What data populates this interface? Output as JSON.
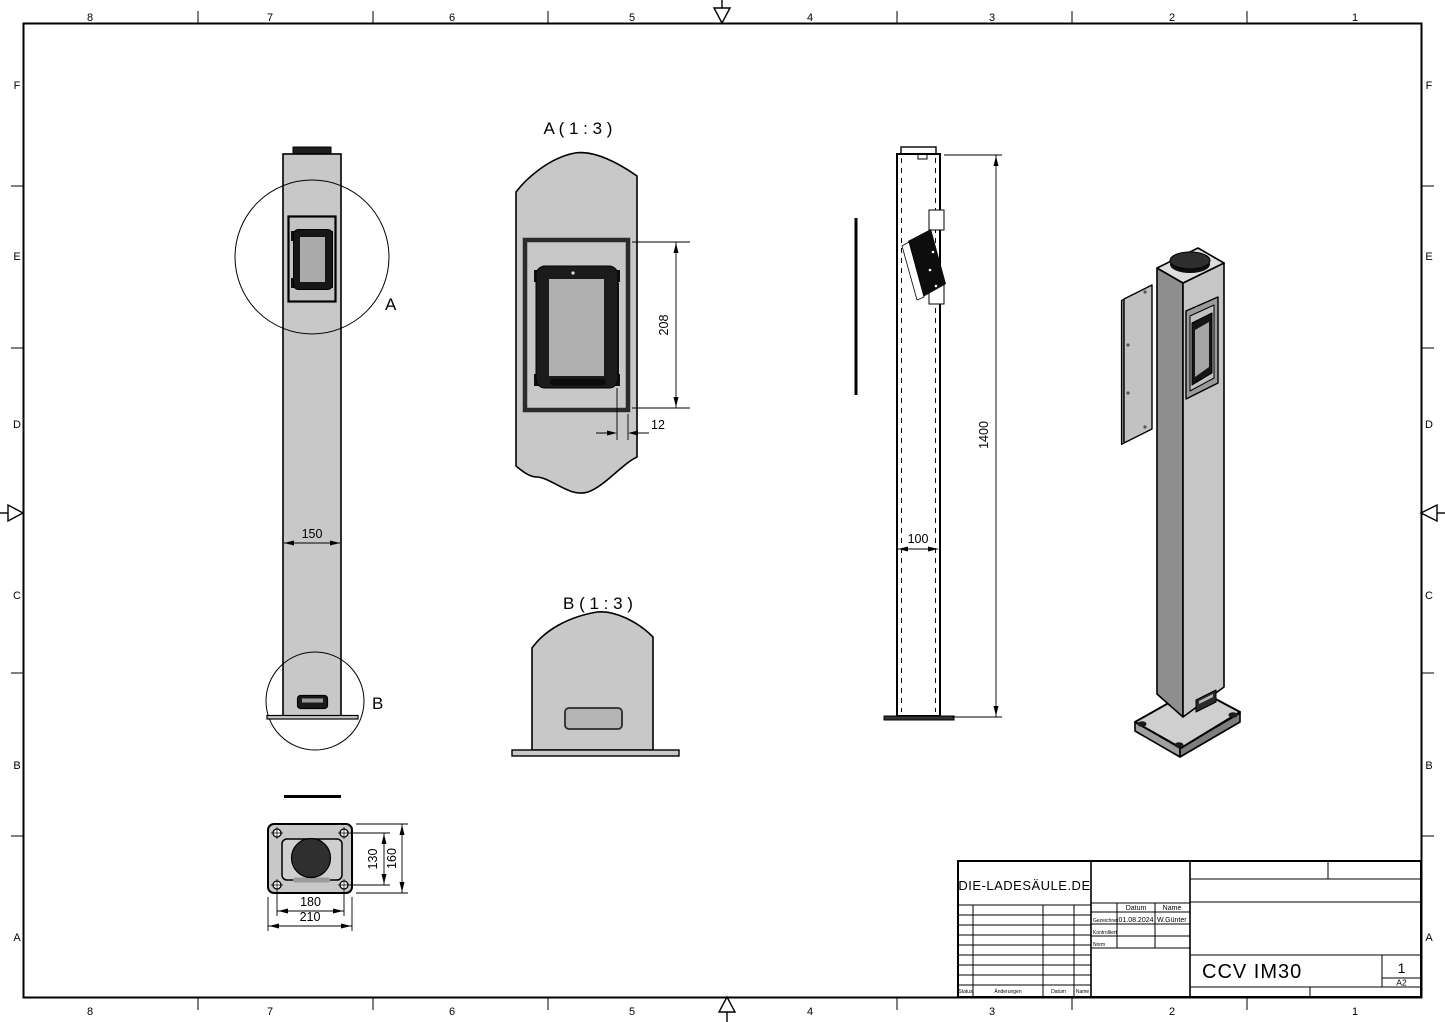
{
  "frame": {
    "columns": [
      "8",
      "7",
      "6",
      "5",
      "4",
      "3",
      "2",
      "1"
    ],
    "rows": [
      "F",
      "E",
      "D",
      "C",
      "B",
      "A"
    ]
  },
  "labels": {
    "detail_a": "A ( 1 : 3 )",
    "detail_b": "B ( 1 : 3 )",
    "callout_a": "A",
    "callout_b": "B"
  },
  "dimensions": {
    "front_width": "150",
    "recess_height": "208",
    "recess_offset": "12",
    "column_height": "1400",
    "column_depth": "100",
    "base_hole_spacing_y": "130",
    "base_depth": "160",
    "base_hole_spacing_x": "180",
    "base_width": "210"
  },
  "title_block": {
    "company": "DIE-LADESÄULE.DE",
    "part_name": "CCV IM30",
    "sheet_number": "1",
    "paper_format": "A2",
    "col_datum": "Datum",
    "col_name": "Name",
    "row_drawn_label": "Gezeichnet",
    "row_drawn_date": "01.08.2024",
    "row_drawn_name": "W.Günter",
    "row_checked_label": "Kontrolliert",
    "row_norm_label": "Norm",
    "rev_status": "Status",
    "rev_changes": "Änderungen",
    "rev_date": "Datum",
    "rev_name": "Name"
  }
}
